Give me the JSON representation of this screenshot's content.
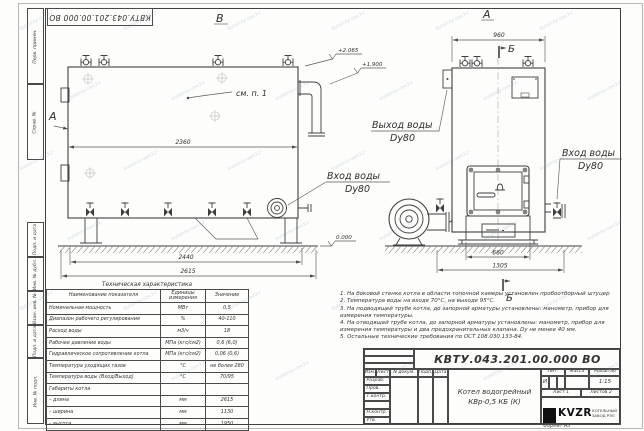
{
  "designation": "КВТУ.043.201.00.000  ВО",
  "frame": {
    "side_top": [
      "Перв. примен.",
      "Справ. №"
    ],
    "side_bottom": [
      "Подп. и дата",
      "Инв. № дубл.",
      "Взам. инв. №",
      "Подп. и дата",
      "Инв. № подл."
    ],
    "format_note": "Формат  А3"
  },
  "drawing": {
    "view_b_label": "В",
    "view_a_label": "А",
    "view_arrow_label": "А",
    "section_label_top": "Б",
    "section_label_bottom": "Б",
    "see_note": "см. п. 1",
    "outlet_label_1": "Выход воды",
    "outlet_label_2": "Dy80",
    "inlet_side_label_1": "Вход воды",
    "inlet_side_label_2": "Dy80",
    "inlet_front_label_1": "Вход воды",
    "inlet_front_label_2": "Dy80",
    "dims": {
      "side_top": "2360",
      "side_supports": "2440",
      "side_total": "2615",
      "front_top": "960",
      "front_door": "660",
      "front_base": "1305"
    },
    "elevations": {
      "top": "+2.065",
      "outlet": "+1.900",
      "ground": "0.000"
    }
  },
  "tech_table": {
    "title": "Техническая характеристика",
    "headers": [
      "Наименование показателя",
      "Единицы измерения",
      "Значение"
    ],
    "rows": [
      {
        "name": "Номинальная мощность",
        "unit": "МВт",
        "value": "0,5"
      },
      {
        "name": "Диапазон рабочего регулирования",
        "unit": "%",
        "value": "40-110"
      },
      {
        "name": "Расход воды",
        "unit": "м3/ч",
        "value": "18"
      },
      {
        "name": "Рабочее давление воды",
        "unit": "МПа (кгс/см2)",
        "value": "0,6 (6,0)"
      },
      {
        "name": "Гидравлическое сопротивление котла",
        "unit": "МПа (кгс/см2)",
        "value": "0,06 (0,6)"
      },
      {
        "name": "Температура уходящих газов",
        "unit": "°С",
        "value": "не более 280"
      },
      {
        "name": "Температура воды (Вход/Выход)",
        "unit": "°С",
        "value": "70/95"
      },
      {
        "name": "Габариты котла",
        "unit": "",
        "value": ""
      },
      {
        "name": "– длина",
        "unit": "мм",
        "value": "2615"
      },
      {
        "name": "– ширина",
        "unit": "мм",
        "value": "1130"
      },
      {
        "name": "– высота",
        "unit": "мм",
        "value": "1950"
      }
    ]
  },
  "notes": [
    "1.  На боковой стенке котла в области топочной камеры установлен пробоотборный штуцер",
    "2.  Температура воды на входе 70°С, на выходе 95°С.",
    "3.  На подводящей трубе котла, до запорной арматуры установлены: манометр, прибор для измерения температуры.",
    "4.  На отводящей трубе котла, до запорной арматуры установлены: манометр, прибор для измерения температуры и два предохранительных клапана. Dу не менее 40 мм.",
    "5.  Остальные технические требования по ОСТ 108.030.133-84."
  ],
  "title_block": {
    "change_header": [
      "Изм.",
      "Лист",
      "N докум.",
      "Подп.",
      "Дата"
    ],
    "sign_rows": [
      "Разраб.",
      "Пров.",
      "Т.контр.",
      "",
      "Н.контр.",
      "Утв."
    ],
    "doc_name_1": "Котел водогрейный",
    "doc_name_2": "КВр-0,5  КБ  (К)",
    "lit_header": [
      "Лит.",
      "Масса",
      "Масштаб"
    ],
    "lit_value": "И",
    "scale": "1:15",
    "sheet": "Лист  1",
    "sheets": "Листов  2",
    "logo_text": "KVZR",
    "logo_sub_1": "КОТЕЛЬНЫЙ",
    "logo_sub_2": "ЗАВОД РЭП"
  },
  "watermark": "kotelniy-zav.kz"
}
